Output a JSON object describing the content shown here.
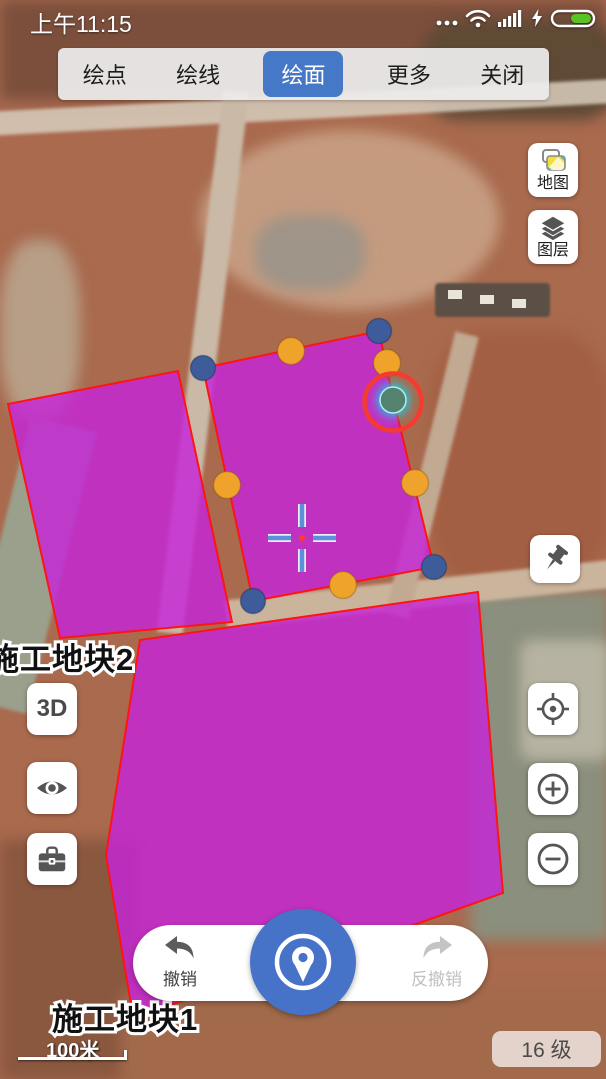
{
  "status_bar": {
    "time": "上午11:15"
  },
  "toolbar": {
    "tabs": [
      {
        "label": "绘点",
        "active": false
      },
      {
        "label": "绘线",
        "active": false
      },
      {
        "label": "绘面",
        "active": true
      },
      {
        "label": "更多",
        "active": false
      },
      {
        "label": "关闭",
        "active": false
      }
    ]
  },
  "side_controls": {
    "map_button_label": "地图",
    "layers_button_label": "图层",
    "three_d_label": "3D"
  },
  "bottom_bar": {
    "undo_label": "撤销",
    "redo_label": "反撤销"
  },
  "map_overlay": {
    "plot_labels": [
      {
        "text": "施工地块2"
      },
      {
        "text": "施工地块1"
      }
    ],
    "scale_label": "100米",
    "zoom_level_label": "16 级",
    "polygons": [
      {
        "name": "plot-polygon-left",
        "points": "8,404 178,371 232,622 60,638"
      },
      {
        "name": "plot-polygon-active",
        "points": "203,368 379,331 393,398 434,567 253,601"
      },
      {
        "name": "plot-polygon-bottom",
        "points": "140,640 478,592 503,893 397,931 133,1017 106,855"
      }
    ],
    "vertex_handles": [
      [
        379,
        331
      ],
      [
        203,
        368
      ],
      [
        434,
        567
      ],
      [
        253,
        601
      ]
    ],
    "midpoint_handles": [
      [
        291,
        351
      ],
      [
        387,
        363
      ],
      [
        415,
        483
      ],
      [
        343,
        585
      ],
      [
        227,
        485
      ]
    ],
    "selected_vertex": {
      "x": 393,
      "y": 400
    },
    "crosshair": {
      "x": 302,
      "y": 538
    },
    "colors": {
      "plot_fill": "#c624d8",
      "plot_outline": "#ff1414",
      "vertex": "#3e5c99",
      "midpoint": "#f0a32b",
      "selected_fill": "#53826f",
      "selected_glow": "#00dcff",
      "selection_ring": "#f53b30",
      "accent_blue": "#4678c8",
      "crosshair_blue": "#5f8fd8"
    }
  },
  "icons": {
    "status": [
      "ellipsis-icon",
      "wifi-icon",
      "signal-bars-icon",
      "charging-bolt-icon",
      "battery-icon"
    ],
    "controls": [
      "map-switch-icon",
      "layers-icon",
      "pushpin-icon",
      "locate-icon",
      "zoom-in-icon",
      "zoom-out-icon",
      "eye-icon",
      "toolbox-icon"
    ],
    "bottom": [
      "undo-arrow-icon",
      "redo-arrow-icon",
      "location-pin-icon"
    ]
  }
}
